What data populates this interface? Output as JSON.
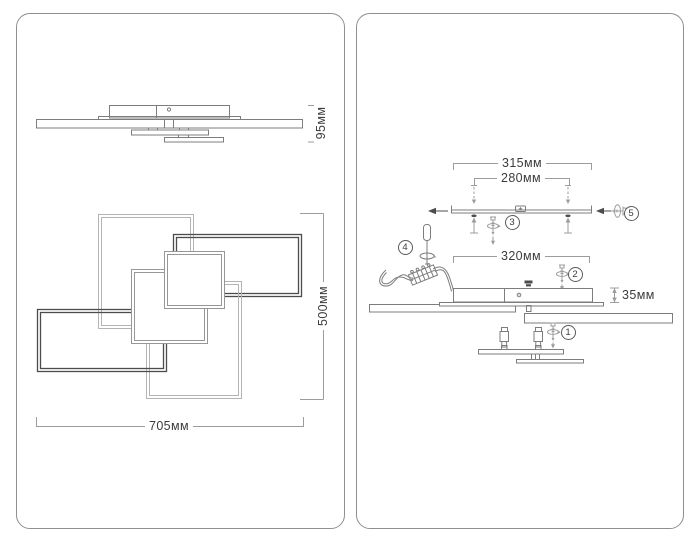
{
  "front_view": {
    "height_label": "95мм",
    "depth_label": "500мм",
    "width_label": "705мм"
  },
  "assembly_view": {
    "bracket_width_label": "315мм",
    "hole_spacing_label": "280мм",
    "canopy_width_label": "320мм",
    "canopy_height_label": "35мм",
    "step_badges": [
      "1",
      "2",
      "3",
      "4",
      "5"
    ]
  },
  "colors": {
    "panel_border": "#8f8f8f",
    "line": "#7d7d7d",
    "line_dark": "#4c4c4c",
    "line_light": "#b4b4b4",
    "line_mid": "#979797",
    "dim": "#9c9c9c",
    "text": "#3c3c3c",
    "bg": "#ffffff"
  }
}
